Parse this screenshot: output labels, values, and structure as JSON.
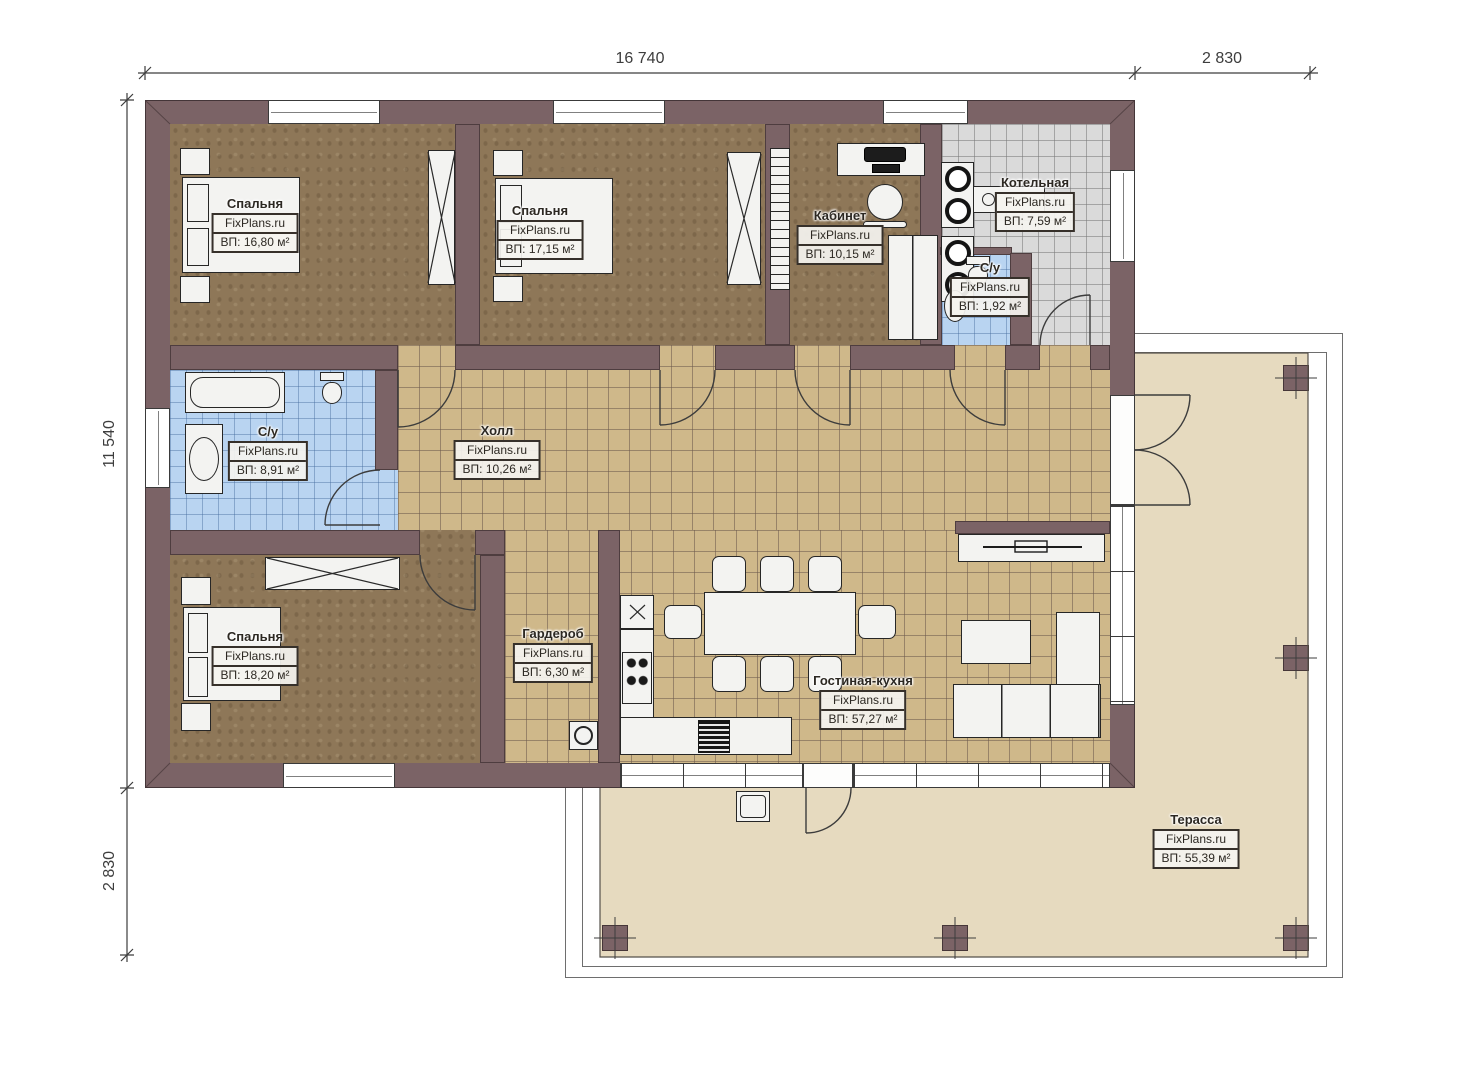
{
  "watermark": "FixPlans.ru",
  "dimensions": {
    "top_main": "16 740",
    "top_right": "2 830",
    "left_main": "11 540",
    "left_bottom": "2 830"
  },
  "rooms": [
    {
      "id": "bedroom-1",
      "name": "Спальня",
      "site": "FixPlans.ru",
      "area": "ВП: 16,80 м²"
    },
    {
      "id": "bedroom-2",
      "name": "Спальня",
      "site": "FixPlans.ru",
      "area": "ВП: 17,15 м²"
    },
    {
      "id": "office",
      "name": "Кабинет",
      "site": "FixPlans.ru",
      "area": "ВП: 10,15 м²"
    },
    {
      "id": "boiler-room",
      "name": "Котельная",
      "site": "FixPlans.ru",
      "area": "ВП: 7,59 м²"
    },
    {
      "id": "wc-small",
      "name": "С/у",
      "site": "FixPlans.ru",
      "area": "ВП: 1,92 м²"
    },
    {
      "id": "bathroom",
      "name": "С/у",
      "site": "FixPlans.ru",
      "area": "ВП: 8,91 м²"
    },
    {
      "id": "hall",
      "name": "Холл",
      "site": "FixPlans.ru",
      "area": "ВП: 10,26 м²"
    },
    {
      "id": "bedroom-3",
      "name": "Спальня",
      "site": "FixPlans.ru",
      "area": "ВП: 18,20 м²"
    },
    {
      "id": "wardrobe",
      "name": "Гардероб",
      "site": "FixPlans.ru",
      "area": "ВП: 6,30 м²"
    },
    {
      "id": "living-kitchen",
      "name": "Гостиная-кухня",
      "site": "FixPlans.ru",
      "area": "ВП: 57,27 м²"
    },
    {
      "id": "terrace",
      "name": "Терасса",
      "site": "FixPlans.ru",
      "area": "ВП: 55,39 м²"
    }
  ],
  "colors": {
    "wall": "#7b6366",
    "bedroom_floor": "#8e7758",
    "tile_floor": "#cfb88a",
    "bathroom_tile": "#b9d4f1",
    "boiler_tile": "#dadada",
    "terrace_floor": "#e6dabf"
  }
}
